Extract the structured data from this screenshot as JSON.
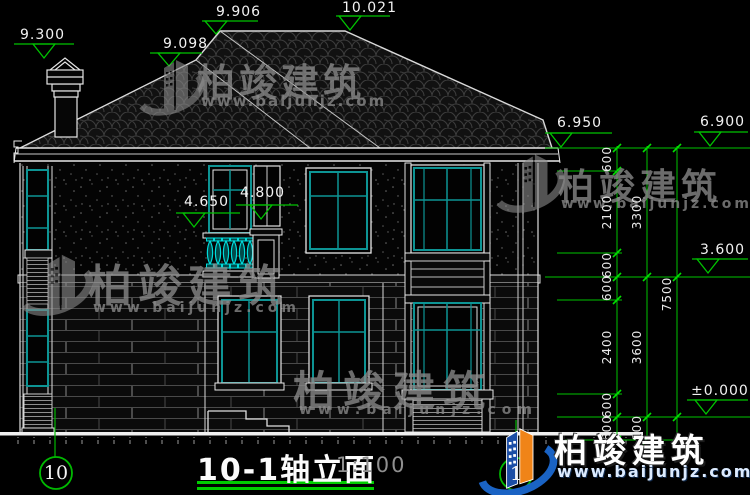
{
  "drawing": {
    "title": "10-1轴立面",
    "scale": "1:100",
    "axis_left": "10",
    "axis_right": "1"
  },
  "elevation_markers": {
    "chimney_top": "9.300",
    "left_hip": "9.098",
    "ridge_left": "9.906",
    "ridge_right": "10.021",
    "eave_left": "6.950",
    "eave_right": "6.900",
    "second_floor": "3.600",
    "ground": "±0.000",
    "balcony_rail": "4.650",
    "balcony_pier": "4.800"
  },
  "dims": {
    "inner": [
      "600",
      "2100",
      "600",
      "600",
      "2400",
      "600",
      "600"
    ],
    "middle": [
      "3300",
      "3600",
      "600"
    ],
    "outer": [
      "7500"
    ]
  },
  "watermark": {
    "brand": "柏竣建筑",
    "url": "www.baijunjz.com"
  },
  "logo": {
    "brand": "柏竣建筑",
    "url": "www.baijunjz.com"
  },
  "colors": {
    "dimension_green": "#00c800",
    "frame_teal": "#0d9494",
    "baluster_cyan": "#00dcdc",
    "line_white": "#e8e8e8",
    "watermark_gray": "#8a8a8a",
    "logo_blue": "#1a63c4",
    "logo_orange": "#f08418",
    "underline_green": "#00cc00"
  }
}
